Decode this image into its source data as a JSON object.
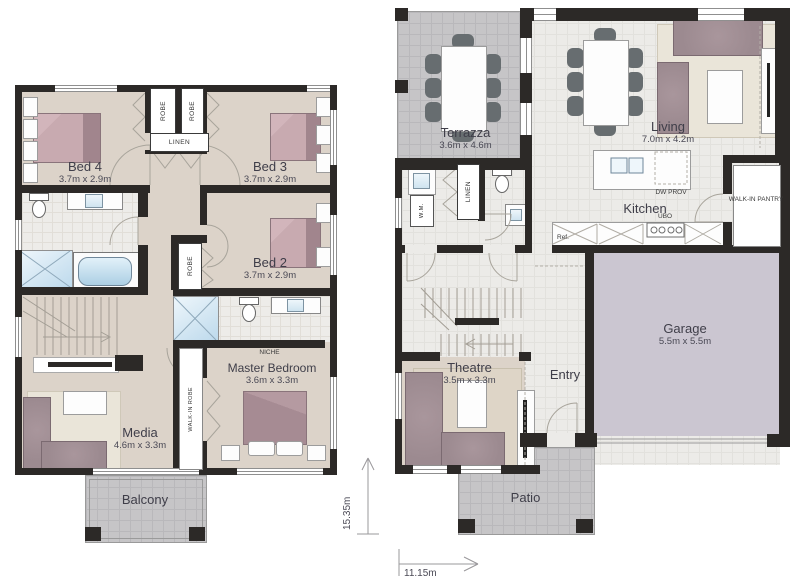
{
  "plans": {
    "upper": {
      "bed4": {
        "name": "Bed 4",
        "dims": "3.7m x 2.9m"
      },
      "bed3": {
        "name": "Bed 3",
        "dims": "3.7m x 2.9m"
      },
      "bed2": {
        "name": "Bed 2",
        "dims": "3.7m x 2.9m"
      },
      "master": {
        "name": "Master Bedroom",
        "dims": "3.6m x 3.3m"
      },
      "media": {
        "name": "Media",
        "dims": "4.6m x 3.3m"
      },
      "balcony": {
        "name": "Balcony"
      },
      "robe": "ROBE",
      "linen": "LINEN",
      "walk_in_robe": "WALK-IN ROBE",
      "niche": "NICHE"
    },
    "ground": {
      "terrazza": {
        "name": "Terrazza",
        "dims": "3.6m x 4.6m"
      },
      "living": {
        "name": "Living",
        "dims": "7.0m x 4.2m"
      },
      "kitchen": {
        "name": "Kitchen"
      },
      "garage": {
        "name": "Garage",
        "dims": "5.5m x 5.5m"
      },
      "theatre": {
        "name": "Theatre",
        "dims": "3.5m x 3.3m"
      },
      "entry": {
        "name": "Entry"
      },
      "patio": {
        "name": "Patio"
      },
      "wm": "W.M.",
      "linen": "LINEN",
      "walk_in_pantry": "WALK-IN PANTRY",
      "dw_prov": "DW PROV",
      "ubo": "UBO",
      "ref": "Ref."
    }
  },
  "dimensions": {
    "height": "15.35m",
    "width": "11.15m"
  },
  "colors": {
    "wall": "#2c2927",
    "floor_beige": "#dcd3c9",
    "floor_light": "#ecebe8",
    "outdoor_gray": "#c6c5c7",
    "garage": "#cbc6d1",
    "furniture_mauve": "#9c8a90",
    "accent_blue": "#bcd9ec"
  }
}
